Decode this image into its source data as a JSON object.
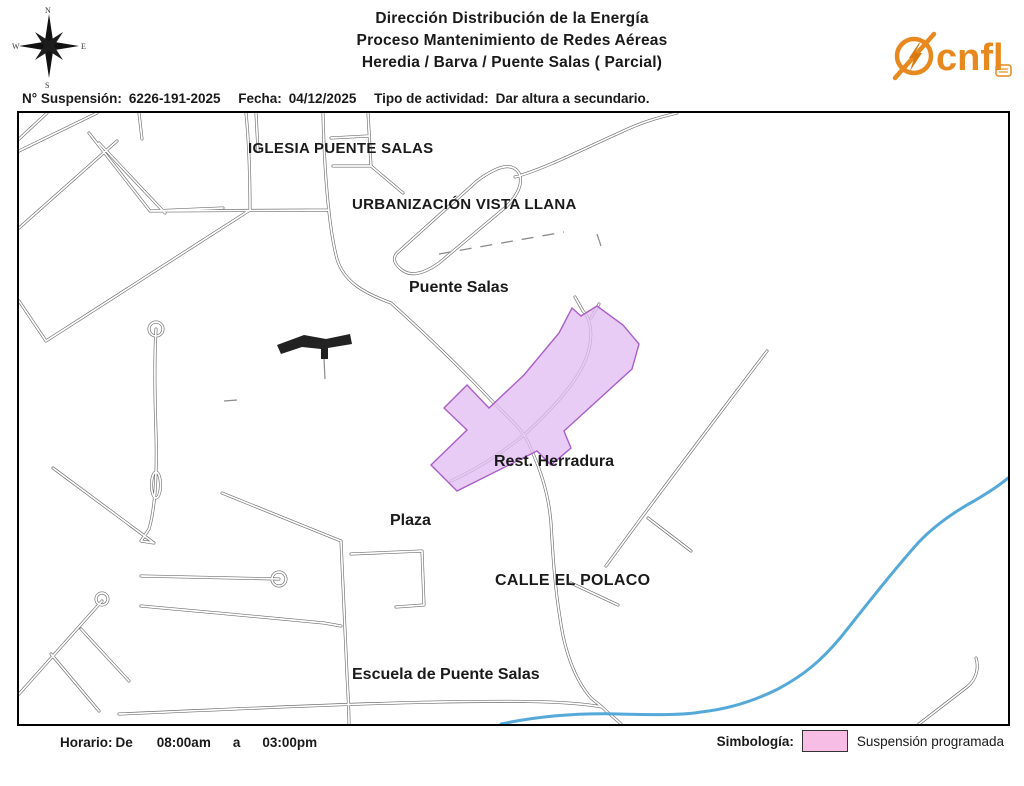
{
  "header": {
    "title_lines": [
      "Dirección Distribución de la Energía",
      "Proceso Mantenimiento de Redes Aéreas",
      "Heredia / Barva / Puente Salas ( Parcial)"
    ],
    "logo_text": "cnfl",
    "compass": {
      "n": "N",
      "e": "E",
      "s": "S",
      "w": "W"
    }
  },
  "info_bar": {
    "suspension_label": "N° Suspensión:",
    "suspension_number": "6226-191-2025",
    "fecha_label": "Fecha:",
    "fecha_value": "04/12/2025",
    "tipo_label": "Tipo de actividad:",
    "tipo_value": "Dar altura a secundario."
  },
  "map": {
    "labels": {
      "iglesia": "IGLESIA PUENTE SALAS",
      "urbanizacion": "URBANIZACIÓN VISTA LLANA",
      "puente_salas": "Puente Salas",
      "rest_herradura": "Rest. Herradura",
      "plaza": "Plaza",
      "calle_polaco": "CALLE EL POLACO",
      "escuela": "Escuela de Puente Salas"
    }
  },
  "footer": {
    "horario_label": "Horario:",
    "de": "De",
    "start": "08:00am",
    "a": "a",
    "end": "03:00pm",
    "simbologia_label": "Simbología:",
    "legend_item": "Suspensión programada"
  },
  "colors": {
    "accent_orange": "#E8891F",
    "suspension_fill": "#E1BEF2",
    "suspension_stroke": "#A95FC8",
    "legend_pink": "#F7BDE4",
    "river_blue": "#55A9D8",
    "road_gray": "#6E6E6E"
  }
}
